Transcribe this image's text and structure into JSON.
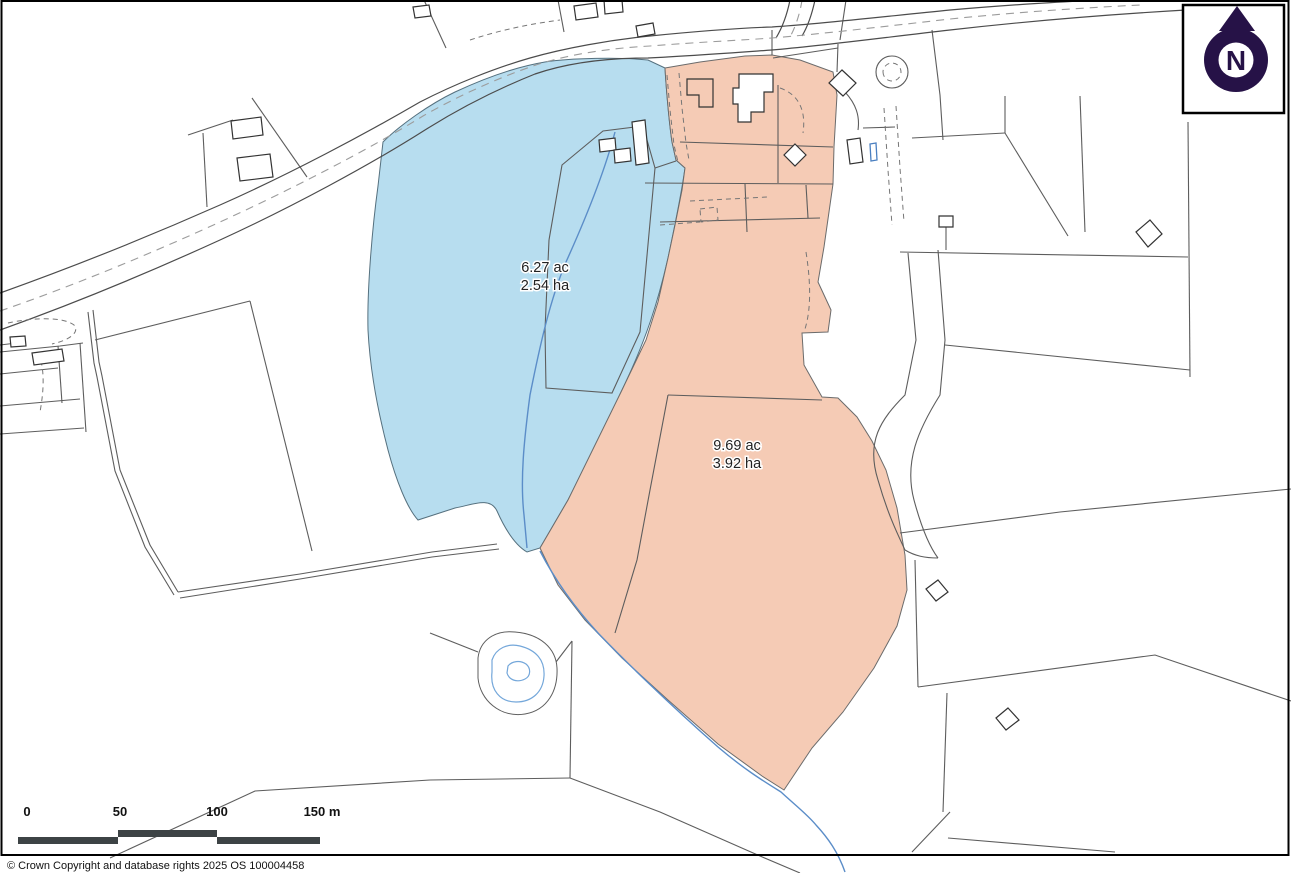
{
  "copyright": "© Crown Copyright and database rights 2025 OS 100004458",
  "north": {
    "letter": "N",
    "color": "#261247"
  },
  "scale_bar": {
    "bar_color": "#3d4345",
    "labels": [
      {
        "text": "0",
        "x": 27
      },
      {
        "text": "50",
        "x": 120
      },
      {
        "text": "100",
        "x": 217
      },
      {
        "text": "150 m",
        "x": 322
      }
    ]
  },
  "parcels": [
    {
      "id": "blue-parcel",
      "area_acres": "6.27 ac",
      "area_hectares": "2.54 ha",
      "fill": "#b7ddef",
      "label_x": 545,
      "label_y": 269
    },
    {
      "id": "pink-parcel",
      "area_acres": "9.69 ac",
      "area_hectares": "3.92 ha",
      "fill": "#f5cbb5",
      "label_x": 737,
      "label_y": 447
    }
  ],
  "colors": {
    "boundary_line": "#5d5d5d",
    "road_line": "#4c4c4c",
    "stream_blue": "#5b8dc8",
    "pond_blue": "#74a7da",
    "north_navy": "#261247",
    "scalebar_gray": "#3d4345",
    "parcel_blue_fill": "#b7ddef",
    "parcel_pink_fill": "#f5cbb5"
  },
  "geometry": {
    "layers": [
      {
        "name": "parcel-blue",
        "paths": [
          "M383,142 C400,125 430,104 455,92 C485,78 515,67 545,62 C570,58 620,57 648,60 L665,68 C666,86 669,122 672,142 L676,160 L685,168 C682,190 675,225 668,258 C658,302 646,340 622,390 C605,427 585,468 568,500 L540,548 L527,552 C515,545 505,529 497,511 C490,496 472,505 455,508 L418,520 C407,508 396,480 388,450 C377,408 370,370 368,330 C367,290 372,230 378,186 Z"
        ]
      },
      {
        "name": "parcel-pink",
        "paths": [
          "M665,68 L700,62 L745,56 L772,55 L800,60 L833,72 L837,95 L834,147 L833,184 L824,247 L818,282 L831,310 L828,332 L802,333 L804,365 L822,397 L838,398 L857,417 L872,441 L886,470 L897,508 L905,555 L907,590 L897,626 L874,668 L843,712 L812,748 L784,790 L762,776 L718,744 L668,700 L622,658 L585,620 L558,585 L540,548 L568,500 L595,445 L622,390 L646,340 L658,302 L668,258 L675,225 L682,190 L685,168 L676,160 L672,142 C669,122 666,86 665,68 Z"
        ]
      },
      {
        "name": "hedges",
        "paths": [
          "M93,310 L99,362 L102,376 L120,470 L150,545 L178,592",
          "M88,312 L94,363 L97,377 L115,471 L145,547 L174,595",
          "M178,592 L300,574 L432,552 L497,544",
          "M180,598 L300,579 L432,557 L499,549",
          "M95,340 L250,301",
          "M250,301 L312,551",
          "M0,345 L25,342",
          "M0,352 L60,346 L83,343",
          "M0,374 L58,368",
          "M58,346 L62,403",
          "M0,406 L80,399",
          "M80,343 L86,432",
          "M0,434 L84,428",
          "M188,135 L233,120",
          "M252,98 L307,177",
          "M203,133 L207,207",
          "M424,0 L446,48",
          "M558,0 L564,32",
          "M549,240 L545,330 L546,388 L612,393 L640,332 L655,168 L643,126 L603,131 L562,165 L549,240",
          "M655,168 L676,161",
          "M668,395 L822,400",
          "M668,395 L650,490 L637,560 L615,633",
          "M645,183 L833,184",
          "M680,142 L833,147",
          "M778,85 L778,183",
          "M745,184 L747,232",
          "M660,222 L820,218",
          "M806,185 L808,218",
          "M772,30 L772,55",
          "M838,44 L837,72",
          "M773,58 L838,48",
          "M846,0 L840,40",
          "M932,30 L940,95 L943,140",
          "M863,128 L895,127",
          "M912,138 L1005,133",
          "M1005,96 L1005,133",
          "M1005,133 L1068,236",
          "M1080,96 L1085,232",
          "M900,252 L1188,257",
          "M1188,122 L1190,377",
          "M945,345 L1190,370",
          "M946,227 L946,250",
          "M908,253 L916,340 L905,395 C880,420 866,442 878,480 C888,515 898,535 905,550",
          "M938,250 L945,340 L940,395 C918,430 904,462 914,500 C921,526 929,546 938,558",
          "M905,550 C915,556 925,558 938,558",
          "M900,533 L1060,512 L1291,489",
          "M915,560 L918,687",
          "M918,687 L1155,655 L1291,701",
          "M947,693 L943,812",
          "M950,812 L912,852",
          "M948,838 L1115,852",
          "M430,633 L478,652",
          "M556,662 L572,641",
          "M572,641 L570,778",
          "M430,780 L570,778",
          "M570,778 L660,812 L760,856 L800,873",
          "M430,780 L255,791 L110,858",
          "M876,72 a16,16 0 1,0 32,0 a16,16 0 1,0 -32,0",
          "M845,92 C856,104 860,116 858,130"
        ]
      },
      {
        "name": "roads",
        "paths": [
          "M0,293 C70,268 150,236 220,205 C290,174 365,134 420,102 C455,84 495,68 530,58 C565,48 610,40 650,36 C700,31 740,28 772,27 C820,24 880,17 950,10 C1020,4 1060,2 1100,0",
          "M0,330 C70,305 150,272 220,240 C290,208 370,165 425,130 C460,108 500,88 535,74 C570,62 610,58 648,58 C690,56 730,53 772,50 C820,46 880,38 950,30 C1020,22 1100,15 1186,10",
          "M776,38 C782,28 787,15 790,0",
          "M802,36 C808,26 812,14 815,0"
        ]
      },
      {
        "name": "road-dashes",
        "paths": [
          "M0,311 C70,287 150,254 220,222 C290,190 368,150 423,116 C458,96 498,78 533,66 C568,54 612,48 650,46 C700,42 745,40 772,38 C820,34 880,27 950,19 C1020,12 1080,8 1140,5",
          "M802,0 C800,14 795,28 790,37"
        ]
      },
      {
        "name": "detail-dashes",
        "paths": [
          "M667,75 L670,110 L674,145 L678,162",
          "M679,73 L682,108 L686,143 L689,160",
          "M780,88 C800,95 806,112 803,133",
          "M690,201 L768,197",
          "M700,209 L717,207 L718,220 L701,222 Z",
          "M660,225 L700,222",
          "M806,252 C812,290 810,315 804,332",
          "M884,108 L888,170 L892,225",
          "M896,106 L900,168 L904,222",
          "M8,323 C30,318 62,316 74,325 C80,332 70,340 52,344",
          "M38,352 C45,368 44,390 40,412",
          "M470,40 C500,30 530,24 560,20",
          "M883,72 a9,9 0 1,0 18,0 a9,9 0 1,0 -18,0"
        ]
      },
      {
        "name": "streams",
        "paths": [
          "M615,132 C605,170 585,220 566,262 C550,300 540,345 530,395 C524,440 520,480 524,515 L527,548",
          "M540,551 C555,580 575,608 598,633 C622,658 668,703 718,747 C745,770 765,782 781,792 C795,805 808,815 816,825 C828,838 838,852 845,872"
        ]
      },
      {
        "name": "pond-outline",
        "paths": [
          "M478,658 C480,640 495,630 515,632 C540,634 556,648 557,668 C558,690 548,710 525,714 C500,718 480,700 478,678 Z"
        ]
      },
      {
        "name": "pond-water",
        "paths": [
          "M492,660 C496,648 508,643 520,646 C536,650 545,660 544,676 C543,692 532,702 516,702 C500,702 490,690 492,672 Z",
          "M508,666 C512,661 520,660 526,664 C531,668 531,676 525,679 C517,683 509,680 507,673 Z"
        ]
      },
      {
        "name": "buildings",
        "paths": [
          "M231,121 L261,117 L263,135 L233,139 Z",
          "M237,158 L270,154 L273,177 L240,181 Z",
          "M413,7 L429,5 L431,16 L415,18 Z",
          "M574,6 L596,3 L598,17 L576,20 Z",
          "M604,0 L622,0 L623,12 L605,14 Z",
          "M636,26 L653,23 L655,34 L638,37 Z",
          "M739,74 L773,74 L773,92 L764,92 L764,112 L751,112 L751,122 L738,122 L738,104 L733,104 L733,88 L739,88 Z",
          "M599,140 L615,138 L616,150 L600,152 Z",
          "M614,150 L630,148 L631,161 L615,163 Z",
          "M632,122 L645,120 L649,163 L636,165 Z",
          "M842,70 L856,83 L843,96 L829,83 Z",
          "M795,144 L806,155 L795,166 L784,155 Z",
          "M847,140 L860,138 L863,162 L850,164 Z",
          "M939,216 L953,216 L953,227 L939,227 Z",
          "M1150,220 L1162,234 L1148,247 L1136,232 Z",
          "M938,580 L948,592 L936,601 L926,589 Z",
          "M1008,708 L1019,720 L1006,730 L996,718 Z",
          "M10,337 L25,336 L26,346 L11,347 Z",
          "M32,353 L62,349 L64,361 L34,365 Z"
        ]
      },
      {
        "name": "buildings-open",
        "paths": [
          "M687,79 L713,79 L713,107 L699,107 L699,95 L687,95 Z"
        ]
      },
      {
        "name": "tank",
        "paths": [
          "M870,144 L876,143 L877,160 L871,161 Z"
        ]
      }
    ]
  }
}
